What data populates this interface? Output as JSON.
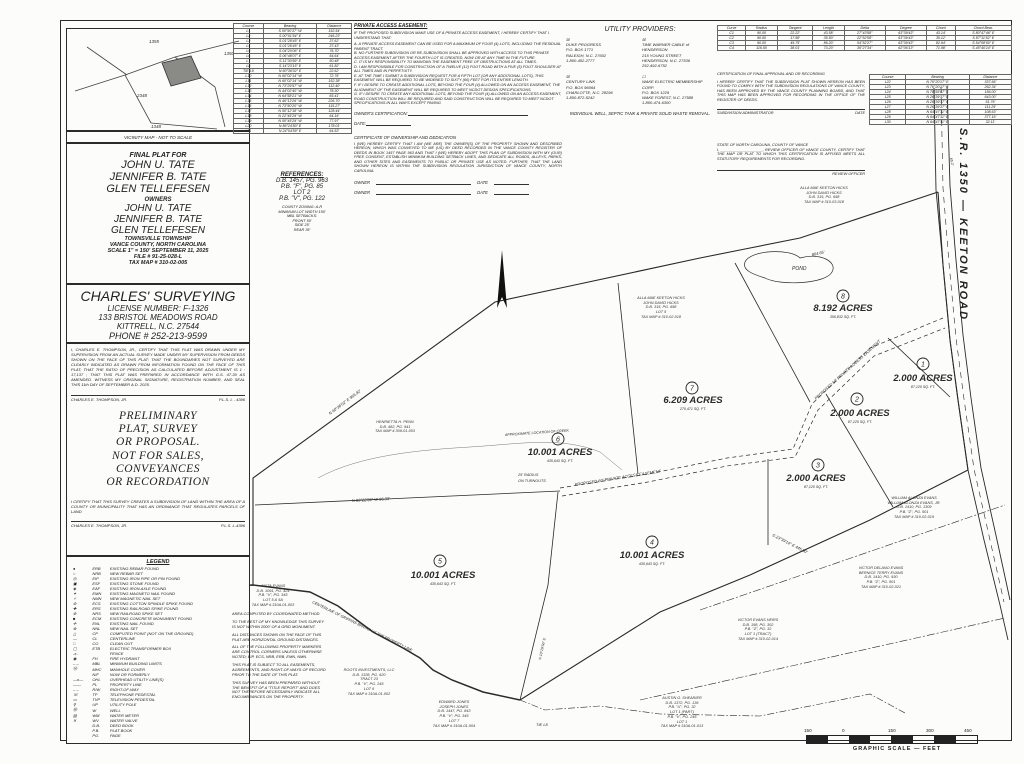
{
  "vicinity": {
    "caption": "VICINITY MAP - NOT TO SCALE",
    "road_numbers": [
      "1355",
      "1350",
      "2348",
      "1348"
    ]
  },
  "title_block": {
    "final_plat_for": "FINAL PLAT FOR",
    "names": [
      "JOHN U. TATE",
      "JENNIFER B. TATE",
      "GLEN TELLEFESEN"
    ],
    "owners_label": "OWNERS",
    "owner_names": [
      "JOHN U. TATE",
      "JENNIFER B. TATE",
      "GLEN TELLEFESEN"
    ],
    "township": "TOWNSVILLE TOWNSHIP",
    "county": "VANCE COUNTY, NORTH CAROLINA",
    "scale_date": "SCALE 1\" = 150'  SEPTEMBER 11, 2025",
    "file_no": "FILE # 91-25-028-L",
    "tax_map": "TAX MAP # 310-02-005"
  },
  "surveyor": {
    "firm": "CHARLES' SURVEYING",
    "license": "LICENSE NUMBER: F-1326",
    "address": "133 BRISTOL MEADOWS ROAD",
    "city": "KITTRELL, N.C. 27544",
    "phone": "PHONE # 252-213-9599",
    "certification": "I, CHARLES E. THOMPSON, JR., CERTIFY THAT THIS PLAT WAS DRAWN UNDER MY SUPERVISION FROM AN ACTUAL SURVEY MADE UNDER MY SUPERVISION FROM DEEDS SHOWN ON THE FACE OF THIS PLAT; THAT THE BOUNDARIES NOT SURVEYED ARE CLEARLY INDICATED AS DRAWN FROM INFORMATION FOUND ON THE FACE OF THIS PLAT; THAT THE RATIO OF PRECISION AS CALCULATED BEFORE ADJUSTMENT IS 1 : 17,137 ; THAT THIS PLAT WAS PREPARED IN ACCORDANCE WITH G.S. 47-30 AS AMENDED. WITNESS MY ORIGINAL SIGNATURE, REGISTRATION NUMBER, AND SEAL THIS 11th DAY OF SEPTEMBER A.D. 2025.",
    "signature": "CHARLES E. THOMPSON, JR.",
    "reg": "P.L.S. L - 4396"
  },
  "preliminary": {
    "lines": [
      "PRELIMINARY",
      "PLAT, SURVEY",
      "OR PROPOSAL.",
      "NOT FOR SALES,",
      "CONVEYANCES",
      "OR RECORDATION"
    ]
  },
  "subdivision_cert": {
    "text": "I CERTIFY THAT THIS SURVEY CREATES A SUBDIVISION OF LAND WITHIN THE AREA OF A COUNTY OR MUNICIPALITY THAT HAS AN ORDINANCE THAT REGULATES PARCELS OF LAND",
    "signature": "CHARLES E. THOMPSON, JR.",
    "reg": "P.L.S. L-4396"
  },
  "legend": {
    "title": "LEGEND",
    "rows": [
      [
        "●",
        "ERB",
        "EXISTING REBAR FOUND"
      ],
      [
        "○",
        "NRB",
        "NEW REBAR SET"
      ],
      [
        "◎",
        "EIP",
        "EXISTING IRON PIPE OR PIN FOUND"
      ],
      [
        "▣",
        "ESF",
        "EXISTING STONE FOUND"
      ],
      [
        "◈",
        "EAF",
        "EXISTING IRON AXLE FOUND"
      ],
      [
        "✦",
        "EMN",
        "EXISTING MAGNETO NAIL FOUND"
      ],
      [
        "✧",
        "NMN",
        "NEW MAGNETIC NAIL SET"
      ],
      [
        "⊛",
        "ECS",
        "EXISTING COTTON SPINDLE SPIKE FOUND"
      ],
      [
        "✚",
        "ERS",
        "EXISTING RAILROAD SPIKE FOUND"
      ],
      [
        "⊕",
        "NRS",
        "NEW RAILROAD SPIKE SET"
      ],
      [
        "■",
        "ECM",
        "EXISTING CONCRETE MONUMENT FOUND"
      ],
      [
        "✛",
        "ENL",
        "EXISTING NAIL FOUND"
      ],
      [
        "⊗",
        "NNL",
        "NEW NAIL SET"
      ],
      [
        "△",
        "CP",
        "COMPUTED POINT (NOT ON THE GROUND)"
      ],
      [
        "—",
        "CL",
        "CENTERLINE"
      ],
      [
        "□",
        "CO",
        "CLEAN OUT"
      ],
      [
        "▢",
        "ETB",
        "ELECTRIC TRANSFORMER BOX"
      ],
      [
        "-x-",
        "",
        "FENCE"
      ],
      [
        "◉",
        "FH",
        "FIRE HYDRANT"
      ],
      [
        "– –",
        "MBL",
        "MINIMUM BUILDING LIMITS"
      ],
      [
        "Ⓜ",
        "MHC",
        "MANHOLE COVER"
      ],
      [
        "",
        "N/F",
        "NOW OR FORMERLY"
      ],
      [
        "—o—",
        "OHL",
        "OVERHEAD UTILITY LINE(S)"
      ],
      [
        "——",
        "PL",
        "PROPERTY LINE"
      ],
      [
        "– –",
        "R/W",
        "RIGHT-OF-WAY"
      ],
      [
        "☏",
        "TP",
        "TELEPHONE PEDESTAL"
      ],
      [
        "▭",
        "TVP",
        "TELEVISION PEDESTAL"
      ],
      [
        "⚲",
        "UP",
        "UTILITY POLE"
      ],
      [
        "Ⓦ",
        "W",
        "WELL"
      ],
      [
        "▤",
        "WM",
        "WATER METER"
      ],
      [
        "✕",
        "WV",
        "WATER VALVE"
      ],
      [
        "",
        "D.B.",
        "DEED BOOK"
      ],
      [
        "",
        "P.B.",
        "PLAT BOOK"
      ],
      [
        "",
        "PG.",
        "PAGE"
      ]
    ]
  },
  "references": {
    "title": "REFERENCES:",
    "lines": [
      "D.B. 1457, PG. 963",
      "P.B. \"F\", PG. 85",
      "LOT 2",
      "P.B. \"V\", PG. 122"
    ],
    "zoning": [
      "COUNTY ZONING: A-R",
      "MINIMUM LOT WIDTH 150'",
      "MBL SETBACKS:",
      "FRONT 50'",
      "SIDE 25'",
      "REAR 35'"
    ]
  },
  "line_table_left": {
    "headers": [
      "Course",
      "Bearing",
      "Distance"
    ],
    "rows": [
      [
        "L1",
        "S 00°50'37\" W",
        "152.54'"
      ],
      [
        "L2",
        "S 00°01'54\" E",
        "246.23'"
      ],
      [
        "L3",
        "S 01°28'45\" E",
        "37.62'"
      ],
      [
        "L4",
        "S 01°28'45\" E",
        "37.43'"
      ],
      [
        "L5",
        "S 04°20'06\" E",
        "76.70'"
      ],
      [
        "L6",
        "S 06°48'07\" E",
        "54.64'"
      ],
      [
        "L7",
        "S 11°30'59\" E",
        "50.48'"
      ],
      [
        "L8",
        "S 14°23'15\" E",
        "61.82'"
      ],
      [
        "TIE L9",
        "N 60°36'02\" E",
        "22.62'"
      ],
      [
        "L10",
        "N 60°02'14\" W",
        "72.76'"
      ],
      [
        "L11",
        "N 60°02'14\" W",
        "152.38'"
      ],
      [
        "L12",
        "N 73°29'57\" W",
        "112.40'"
      ],
      [
        "L13",
        "N 44°02'40\" W",
        "78.30'"
      ],
      [
        "L14",
        "N 64°58'21\" W",
        "65.41'"
      ],
      [
        "L15",
        "N 46°13'26\" W",
        "226.70'"
      ],
      [
        "L16",
        "N 73°50'20\" W",
        "115.27'"
      ],
      [
        "L17",
        "N 50°12'18\" W",
        "128.44'"
      ],
      [
        "L18",
        "N 22°45'29\" W",
        "64.16'"
      ],
      [
        "L19",
        "N 50°45'29\" W",
        "77.97'"
      ],
      [
        "L20",
        "N 86°24'50\" E",
        "178.01'"
      ],
      [
        "L21",
        "N 24°04'59\" E",
        "64.53'"
      ]
    ]
  },
  "line_table_right": {
    "headers": [
      "Course",
      "Bearing",
      "Distance"
    ],
    "rows": [
      [
        "L22",
        "N 76°20'17\" E",
        "337.66'"
      ],
      [
        "L23",
        "N 76°20'17\" E",
        "262.34'"
      ],
      [
        "L24",
        "N 78°55'47\" E",
        "156.00'"
      ],
      [
        "L25",
        "N 26°39'37\" E",
        "643.00'"
      ],
      [
        "L26",
        "N 26°39'37\" E",
        "51.76'"
      ],
      [
        "L27",
        "N 26°39'37\" E",
        "111.29'"
      ],
      [
        "L28",
        "N 64°47'11\" E",
        "108.63'"
      ],
      [
        "L29",
        "N 64°47'11\" E",
        "377.16'"
      ],
      [
        "L30",
        "N 64°47'11\" E",
        "32.11'"
      ]
    ]
  },
  "curve_table": {
    "headers": [
      "Curve",
      "Radius",
      "Tangent",
      "Length",
      "Delta",
      "Degree",
      "Chord",
      "Chord Bear."
    ],
    "rows": [
      [
        "C1",
        "90.00",
        "22.22'",
        "43.58'",
        "27°43'58\"",
        "63°39'43\"",
        "43.14'",
        "S 80°47'46\" E"
      ],
      [
        "C2",
        "90.00",
        "17.98'",
        "35.50'",
        "22°52'08\"",
        "63°39'43\"",
        "35.12'",
        "S 87°11'52\" E"
      ],
      [
        "C3",
        "90.00",
        "45.75'",
        "86.20'",
        "54°52'27\"",
        "63°39'43\"",
        "82.94'",
        "S 54°08'50\" E"
      ],
      [
        "C4",
        "116.50",
        "38.01'",
        "73.20'",
        "36°27'34\"",
        "62°06'13\"",
        "71.98'",
        "S 45°40'24\" E"
      ]
    ]
  },
  "easement_cert": {
    "title": "PRIVATE ACCESS EASEMENT:",
    "intro": "IF THE PROPOSED SUBDIVISION MAKE USE OF A PRIVATE ACCESS EASEMENT, I HEREBY CERTIFY THAT I UNDERSTAND THAT:",
    "items": [
      "A. A PRIVATE ACCESS EASEMENT CAN BE USED FOR A MAXIMUM OF FOUR (4) LOTS, INCLUDING THE RESIDUAL PARENT TRACT.",
      "B. NO FURTHER SUBDIVISION OR RE-SUBDIVISION SHALL BE APPROVED WITH ACCESS TO THIS PRIVATE ACCESS EASEMENT AFTER THE FOURTH LOT IS CREATED, NOW OR AT ANY TIME IN THE FUTURE",
      "C. IT IS MY RESPONSIBILITY TO MAINTAIN THE EASEMENT FREE OF OBSTRUCTIONS AT ALL TIMES.",
      "D. I AM RESPONSIBLE FOR CONSTRUCTION OF A TWELVE (12) FOOT ROAD WITH A FIVE (5) FOOT SHOULDER AT ALL TIMES AND IN PERPETUITY.",
      "E. AT THE TIME I SUBMIT A SUBDIVISION REQUEST FOR A FIFTH LOT (OR ANY ADDITIONAL LOTS), THIS EASEMENT WILL BE REQUIRED TO BE WIDENED TO SIXTY (60) FEET FOR ITS ENTIRE LENGTH.",
      "F. IF I DESIRE TO CREATE ADDITIONAL LOTS, BEYOND THE FOUR (4) ALLOWED ON AN ACCESS EASEMENT, THE ALIGNMENT OF THE EASEMENT WILL BE REQUIRED TO MEET NCDOT DESIGN SPECIFICATIONS.",
      "G. IF I DESIRE TO CREATE ANY ADDITIONAL LOTS, BEYOND THE FOUR (4) ALLOWED ON AN ACCESS EASEMENT, ROAD CONSTRUCTION WILL BE REQUIRED AND SAID CONSTRUCTION WILL BE REQUIRED TO MEET NCDOT SPECIFICATIONS IN ALL WAYS EXCEPT PAVING"
    ],
    "owners_certification": "OWNER'S CERTIFICATION:",
    "date_label": "DATE:"
  },
  "ownership_cert": {
    "title": "CERTIFICATE OF OWNERSHIP AND DEDICATION",
    "text": "I (WE) HEREBY CERTIFY THAT I AM (WE ARE) THE OWNER(S) OF THE PROPERTY SHOWN AND DESCRIBED HEREON, WHICH WAS CONVEYED TO ME (US) BY DEED RECORDED IN THE VANCE COUNTY REGISTER OF DEEDS IN BOOK 1457 PAGE 963 AND THAT I (WE) HEREBY ADOPT THIS PLAN OF SUBDIVISION WITH MY (OUR) FREE CONSENT, ESTABLISH MINIMUM BUILDING SETBACK LINES, AND DEDICATE ALL ROADS, ALLEYS, PARKS, AND OTHER SITES AND EASEMENTS TO PUBLIC OR PRIVATE USE AS NOTED. FURTHER, THAT THE LAND SHOWN HEREON IS WITHIN THE SUBDIVISION REGULATION JURISDICTION OF VANCE COUNTY, NORTH CAROLINA.",
    "owner_label": "OWNER",
    "date_label": "DATE"
  },
  "utilities": {
    "title": "UTILITY PROVIDERS:",
    "providers": [
      {
        "checked": "☒",
        "lines": [
          "DUKE PROGRESS",
          "P.O. BOX 1771",
          "RALEIGH, N.C. 27602",
          "1-800-452-2777"
        ]
      },
      {
        "checked": "☒",
        "lines": [
          "TIME WARNER CABLE of HENDERSON",
          "215 YOUNG STREET",
          "HENDERSON, N.C. 27536",
          "252-492-6752"
        ]
      },
      {
        "checked": "☒",
        "lines": [
          "CENTURY LINK",
          "P.O. BOX 96064",
          "CHARLOTTE, N.C. 28296",
          "1-800-872-5242"
        ]
      },
      {
        "checked": "☐",
        "lines": [
          "WAKE ELECTRIC MEMBERSHIP CORP.",
          "P.O. BOX 1229",
          "WAKE FOREST, N.C. 27588",
          "1-800-474-6300"
        ]
      }
    ],
    "note": "INDIVIDUAL WELL, SEPTIC TANK & PRIVATE SOLID WASTE REMOVAL."
  },
  "approval_cert": {
    "title": "CERTIFICATION OF FINAL APPROVAL AND OR RECORDING",
    "text": "I HEREBY CERTIFY THAT THE SUBDIVISION PLAT SHOWN HEREON HAS BEEN FOUND TO COMPLY WITH THE SUBDIVISION REGULATIONS OF VANCE COUNTY, HAS BEEN APPROVED BY THE VANCE COUNTY PLANNING BOARD, AND THAT THIS MAP HAS BEEN APPROVED FOR RECORDING IN THE OFFICE OF THE REGISTER OF DEEDS.",
    "admin_label": "SUBDIVISION ADMINISTRATOR",
    "date_label": "DATE"
  },
  "review_cert": {
    "line1": "STATE OF NORTH CAROLINA, COUNTY OF VANCE",
    "line2": "I, ____________________, REVIEW OFFICER OF VANCE COUNTY, CERTIFY THAT THE MAP OR PLAT TO WHICH THIS CERTIFICATION IS AFFIXED MEETS ALL STATUTORY REQUIREMENTS FOR RECORDING.",
    "officer_label": "REVIEW OFFICER"
  },
  "road": {
    "label": "S.R. 1350 — KEETON ROAD"
  },
  "plat": {
    "lots": [
      {
        "num": "1",
        "acres": "2.000  ACRES",
        "sqft": "87,120 SQ. FT."
      },
      {
        "num": "2",
        "acres": "2.000  ACRES",
        "sqft": "87,120 SQ. FT."
      },
      {
        "num": "3",
        "acres": "2.000  ACRES",
        "sqft": "87,120 SQ. FT."
      },
      {
        "num": "4",
        "acres": "10.001  ACRES",
        "sqft": "435,643 SQ. FT."
      },
      {
        "num": "5",
        "acres": "10.001  ACRES",
        "sqft": "435,643 SQ. FT."
      },
      {
        "num": "6",
        "acres": "10.001  ACRES",
        "sqft": "435,643 SQ. FT."
      },
      {
        "num": "7",
        "acres": "6.209  ACRES",
        "sqft": "270,471 SQ. FT."
      },
      {
        "num": "8",
        "acres": "8.192  ACRES",
        "sqft": "356,832 SQ. FT."
      }
    ],
    "adjoiners": {
      "penn": [
        "HENRIETTA H. PENN",
        "D.B. 482, PG. 941",
        "TAX MAP # 309-01-003"
      ],
      "hicks_left": [
        "ALLA MAE KEETON HICKS",
        "JOHN DAVID HICKS",
        "D.B. 315, PG. 698",
        "LOT 5",
        "TAX MAP # 310-02-018"
      ],
      "hicks_top": [
        "ALLA MAE KEETON HICKS",
        "JOHN DAVID HICKS",
        "D.B. 315, PG. 698",
        "TAX MAP # 310-03-018"
      ],
      "william": [
        "WILLIAM ALONZA EVANS",
        "WILLIAM ALONZA EVANS, JR.",
        "D.B. 1410, PG. 1309",
        "P.B. \"Z\", PG. 501",
        "TAX MAP # 310-02-019"
      ],
      "victor_delano": [
        "VICTOR DELANO EVANS",
        "BERNICE TERRY EVANS",
        "D.B. 1410, PG. 930",
        "P.B. \"Z\", PG. 501",
        "TAX MAP # 310-02-021"
      ],
      "victor_heirs": [
        "VICTOR EVANS HEIRS",
        "D.B. 198, PG. 302",
        "P.B. \"Z\", PG. 32",
        "LOT 1 (TRACT)",
        "TAX MAP # 310-02-014"
      ],
      "shearier": [
        "AUSTIN G. SHEARIER",
        "D.B. 1372, PG. 136",
        "P.B. \"U\", PG. 32",
        "LOT 1 (PART)",
        "P.B. \"V\", PG. 245",
        "LOT 1",
        "TAX MAP # 310A-01-013"
      ],
      "roots": [
        "ROOTS INVESTMENTS, LLC",
        "D.B. 1328, PG. 620",
        "TRACT 23",
        "P.B. \"V\", PG. 245",
        "LOT 6",
        "TAX MAP # 310A-01-002"
      ],
      "jones": [
        "EDWARD JONES",
        "JOSEPH JONES",
        "D.B. 1447, PG. 843",
        "P.B. \"V\", PG. 345",
        "LOT 7",
        "TAX MAP # 310A-01-004"
      ],
      "anita": [
        "ANITA EVANS",
        "D.B. 1091, PG. 424",
        "P.B. \"V\", PG. 345",
        "LOT 5 & 5A",
        "TAX MAP # 310A-01-003"
      ]
    },
    "labels": {
      "pond": "POND",
      "creek": "APPROXIMATE LOCATION OF CREEK",
      "branch": "CENTERLINE OF GRIFFINS BRANCH IS THE PROPERTY LINE",
      "turnout1": "25' RADIUS",
      "turnout2": "ON TURNOUTS",
      "tie": "TIE L8",
      "easement": "PROPOSED 60' PRIVATE ACCESS EASEMENT"
    },
    "bearings": [
      {
        "t": "N 60°36'02\" E  966.92'"
      },
      {
        "t": "N 86°22'36\" W  96.33'"
      },
      {
        "t": "804.65'"
      },
      {
        "t": "S 23°39'14\" E  445.90'"
      },
      {
        "t": "N 10°29'56\" E"
      },
      {
        "t": "65.0'"
      }
    ]
  },
  "notes": [
    "AREA COMPUTED BY COORDINATED METHOD",
    "TO THE BEST OF MY KNOWLEDGE THIS SURVEY IS NOT WITHIN 2000' OF A GRID MONUMENT.",
    "ALL DISTANCES SHOWN ON THE FACE OF THIS PLAT ARE HORIZONTAL GROUND DISTANCES.",
    "ALL OF THE FOLLOWING PROPERTY MARKERS ARE CONTROL CORNERS UNLESS OTHERWISE NOTED; EIP, ECS, NRB, ERB, EMN, NMN.",
    "THIS PLAT IS SUBJECT TO ALL EASEMENTS, AGREEMENTS, AND RIGHT-OF-WAYS OF RECORD PRIOR TO THE DATE OF THIS PLAT.",
    "THIS SURVEY HAS BEEN PREPARED WITHOUT THE BENEFIT OF A \"TITLE REPORT\" AND DOES NOT THEREFORE NECESSARILY INDICATE ALL ENCUMBRANCES ON THE PROPERTY."
  ],
  "scale_bar": {
    "labels": [
      "150",
      "0",
      "150",
      "300",
      "450"
    ],
    "caption": "GRAPHIC SCALE — FEET"
  }
}
